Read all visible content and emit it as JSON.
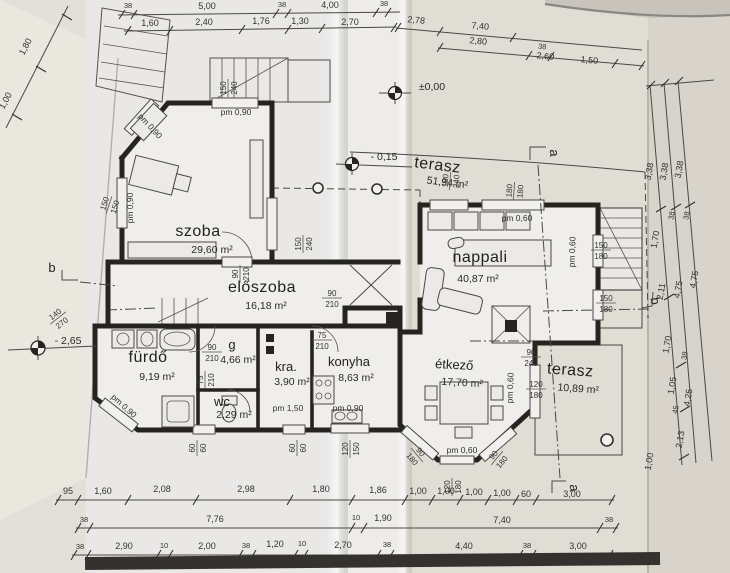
{
  "rooms": {
    "szoba": {
      "name": "szoba",
      "area": "29,60 m²"
    },
    "terasz_felso": {
      "name": "terasz",
      "area": "51,94 m²"
    },
    "nappali": {
      "name": "nappali",
      "area": "40,87 m²"
    },
    "eloszoba": {
      "name": "előszoba",
      "area": "16,18 m²"
    },
    "furdo": {
      "name": "fürdő",
      "area": "9,19 m²"
    },
    "gardrob": {
      "name": "g",
      "area": "4,66 m²"
    },
    "wc": {
      "name": "wc",
      "area": "2,29 m²"
    },
    "kamra": {
      "name": "kra.",
      "area": "3,90 m²"
    },
    "konyha": {
      "name": "konyha",
      "area": "8,63 m²"
    },
    "etkezo": {
      "name": "étkező",
      "area": "17,70 m²"
    },
    "terasz_also": {
      "name": "terasz",
      "area": "10,89 m²"
    }
  },
  "elevations": {
    "ground": "±0,00",
    "terrace": "- 0,15",
    "basement": "- 2,65"
  },
  "sections": {
    "a": "a",
    "b": "b"
  },
  "labels": {
    "pm_090": "pm 0,90",
    "pm_060": "pm 0,60",
    "pm_150": "pm 1,50"
  },
  "fractions": {
    "f150_240": {
      "n": "150",
      "d": "240"
    },
    "f180_240": {
      "n": "180",
      "d": "240"
    },
    "f180_180": {
      "n": "180",
      "d": "180"
    },
    "f150_180": {
      "n": "150",
      "d": "180"
    },
    "f150_150": {
      "n": "150",
      "d": "150"
    },
    "f90_210": {
      "n": "90",
      "d": "210"
    },
    "f75_210": {
      "n": "75",
      "d": "210"
    },
    "f90_240": {
      "n": "90",
      "d": "240"
    },
    "f120_180": {
      "n": "120",
      "d": "180"
    },
    "f120_150": {
      "n": "120",
      "d": "150"
    },
    "f60_60": {
      "n": "60",
      "d": "60"
    },
    "f90_180": {
      "n": "90",
      "d": "180"
    },
    "f140_270": {
      "n": "140",
      "d": "270"
    }
  },
  "dims": {
    "top_row1": [
      "38",
      "5,00",
      "38",
      "4,00",
      "38"
    ],
    "top_row2": [
      "1,60",
      "2,40",
      "1,76",
      "1,30",
      "2,70"
    ],
    "top_right_row1": [
      "2,78",
      "7,40"
    ],
    "top_right_row2": [
      "2,80",
      "38",
      "2,60",
      "1,50"
    ],
    "bottom_row1": [
      "95",
      "1,60",
      "2,08",
      "2,98",
      "1,80",
      "1,86",
      "1,00",
      "1,00",
      "1,00",
      "1,00",
      "60",
      "3,00"
    ],
    "bottom_row2": [
      "38",
      "7,76",
      "10",
      "1,90",
      "7,40",
      "38"
    ],
    "bottom_row3": [
      "38",
      "2,90",
      "10",
      "2,00",
      "38",
      "1,20",
      "10",
      "2,70",
      "38",
      "4,40",
      "38",
      "3,00"
    ],
    "right_chain1": [
      "3,38",
      "1,70",
      "2,11",
      "1,70",
      "1,05",
      "45",
      "2,13",
      "1,00"
    ],
    "right_chain2": [
      "3,38",
      "38",
      "4,75",
      "38",
      "4,25"
    ],
    "right_chain3": [
      "3,38",
      "38",
      "4,75"
    ],
    "left_chain": [
      "1,80",
      "1,00"
    ]
  }
}
